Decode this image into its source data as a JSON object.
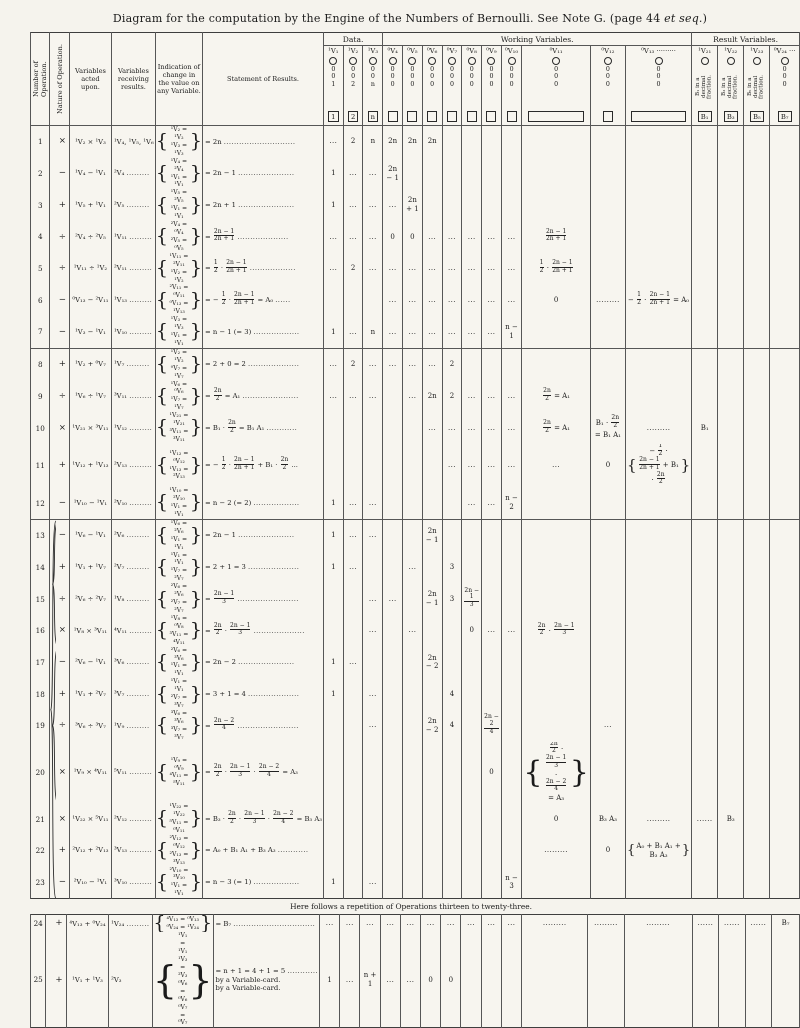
{
  "page": {
    "title_pre": "Diagram for the computation by the Engine of the Numbers of Bernoulli.  See Note G. (page 44 ",
    "title_em": "et seq.",
    "title_post": ")"
  },
  "table": {
    "left_headers": [
      "Number of Operation.",
      "Nature of Operation.",
      "Variables acted upon.",
      "Variables receiving results.",
      "Indication of change in the value on any Variable.",
      "Statement of Results."
    ],
    "groups": {
      "data": "Data.",
      "working": "Working Variables.",
      "result": "Result Variables."
    },
    "banner": "Here follows a repetition of Operations thirteen to twenty-three.",
    "columns": [
      {
        "id": "v1",
        "label": "¹V₁",
        "zeros": [
          "0",
          "0",
          "1"
        ],
        "box": "1"
      },
      {
        "id": "v2",
        "label": "¹V₂",
        "zeros": [
          "0",
          "0",
          "2"
        ],
        "box": "2"
      },
      {
        "id": "v3",
        "label": "¹V₃",
        "zeros": [
          "0",
          "0",
          "n"
        ],
        "box": "n"
      },
      {
        "id": "v4",
        "label": "⁰V₄",
        "zeros": [
          "0",
          "0",
          "0"
        ],
        "box": ""
      },
      {
        "id": "v5",
        "label": "⁰V₅",
        "zeros": [
          "0",
          "0",
          "0"
        ],
        "box": ""
      },
      {
        "id": "v6",
        "label": "⁰V₆",
        "zeros": [
          "0",
          "0",
          "0"
        ],
        "box": ""
      },
      {
        "id": "v7",
        "label": "⁰V₇",
        "zeros": [
          "0",
          "0",
          "0"
        ],
        "box": ""
      },
      {
        "id": "v8",
        "label": "⁰V₈",
        "zeros": [
          "0",
          "0",
          "0"
        ],
        "box": ""
      },
      {
        "id": "v9",
        "label": "⁰V₉",
        "zeros": [
          "0",
          "0",
          "0"
        ],
        "box": ""
      },
      {
        "id": "v10",
        "label": "⁰V₁₀",
        "zeros": [
          "0",
          "0",
          "0"
        ],
        "box": ""
      },
      {
        "id": "v11",
        "label": "⁰V₁₁",
        "zeros": [
          "0",
          "0",
          "0"
        ],
        "box": "",
        "wide": true
      },
      {
        "id": "v12",
        "label": "⁰V₁₂",
        "zeros": [
          "0",
          "0",
          "0"
        ],
        "box": ""
      },
      {
        "id": "v13",
        "label": "⁰V₁₃ ·········",
        "zeros": [
          "0",
          "0",
          "0"
        ],
        "box": "",
        "wide": true
      },
      {
        "id": "v21",
        "label": "¹V₂₁",
        "rot": "B₁ in a decimal fraction.",
        "box": "B₁"
      },
      {
        "id": "v22",
        "label": "¹V₂₂",
        "rot": "B₃ in a decimal fraction.",
        "box": "B₃"
      },
      {
        "id": "v23",
        "label": "¹V₂₃",
        "rot": "B₅ in a decimal fraction.",
        "box": "B₅"
      },
      {
        "id": "v24",
        "label": "⁰V₂₄ ···",
        "zeros": [
          "0",
          "0",
          "0"
        ],
        "box": "B₇"
      }
    ],
    "rows": [
      {
        "block": 1,
        "n": "1",
        "op": "×",
        "a": "¹V₂ × ¹V₃",
        "r": "¹V₄, ¹V₅, ¹V₆",
        "i": [
          "¹V₂ = ¹V₂",
          "¹V₃ = ¹V₃"
        ],
        "s": "= 2n ............................",
        "c": {
          "v1": "...",
          "v2": "2",
          "v3": "n",
          "v4": "2n",
          "v5": "2n",
          "v6": "2n"
        }
      },
      {
        "block": 1,
        "n": "2",
        "op": "−",
        "a": "¹V₄ − ¹V₁",
        "r": "²V₄ .........",
        "i": [
          "¹V₄ = ²V₄",
          "¹V₁ = ¹V₁"
        ],
        "s": "= 2n − 1 ......................",
        "c": {
          "v1": "1",
          "v2": "...",
          "v3": "...",
          "v4": "2n − 1"
        }
      },
      {
        "block": 1,
        "n": "3",
        "op": "+",
        "a": "¹V₅ + ¹V₁",
        "r": "²V₅ .........",
        "i": [
          "¹V₅ = ²V₅",
          "¹V₁ = ¹V₁"
        ],
        "s": "= 2n + 1 ......................",
        "c": {
          "v1": "1",
          "v2": "...",
          "v3": "...",
          "v4": "...",
          "v5": "2n + 1"
        }
      },
      {
        "block": 1,
        "n": "4",
        "op": "÷",
        "a": "²V₄ ÷ ²V₅",
        "r": "¹V₁₁ .........",
        "i": [
          "²V₄ = ⁰V₄",
          "²V₅ = ⁰V₅"
        ],
        "s": "= [[2n − 1|2n + 1]] ....................",
        "c": {
          "v1": "...",
          "v2": "...",
          "v3": "...",
          "v4": "0",
          "v5": "0",
          "v6": "...",
          "v7": "...",
          "v8": "...",
          "v9": "...",
          "v10": "...",
          "v11": "[[2n − 1|2n + 1]]"
        }
      },
      {
        "block": 1,
        "n": "5",
        "op": "÷",
        "a": "¹V₁₁ ÷ ¹V₂",
        "r": "²V₁₁ .........",
        "i": [
          "¹V₁₁ = ²V₁₁",
          "¹V₂ = ¹V₂"
        ],
        "s": "= [[1|2]] · [[2n − 1|2n + 1]] ..................",
        "c": {
          "v1": "...",
          "v2": "2",
          "v3": "...",
          "v4": "...",
          "v5": "...",
          "v6": "...",
          "v7": "...",
          "v8": "...",
          "v9": "...",
          "v10": "...",
          "v11": "[[1|2]] · [[2n − 1|2n + 1]]"
        }
      },
      {
        "block": 1,
        "n": "6",
        "op": "−",
        "a": "⁰V₁₃ − ²V₁₁",
        "r": "¹V₁₃ .........",
        "i": [
          "²V₁₁ = ⁰V₁₁",
          "⁰V₁₃ = ¹V₁₃"
        ],
        "s": "= − [[1|2]] · [[2n − 1|2n + 1]] = A₀ ......",
        "c": {
          "v4": "...",
          "v5": "...",
          "v6": "...",
          "v7": "...",
          "v8": "...",
          "v9": "...",
          "v10": "...",
          "v11": "0",
          "v12": ".........",
          "v13": "− [[1|2]] · [[2n − 1|2n + 1]] = A₀"
        }
      },
      {
        "block": 1,
        "n": "7",
        "op": "−",
        "a": "¹V₃ − ¹V₁",
        "r": "¹V₁₀ .........",
        "i": [
          "¹V₃ = ¹V₃",
          "¹V₁ = ¹V₁"
        ],
        "s": "= n − 1 (= 3) ..................",
        "c": {
          "v1": "1",
          "v2": "...",
          "v3": "n",
          "v4": "...",
          "v5": "...",
          "v6": "...",
          "v7": "...",
          "v8": "...",
          "v9": "...",
          "v10": "n − 1"
        }
      },
      {
        "block": 2,
        "n": "8",
        "op": "+",
        "a": "¹V₂ + ⁰V₇",
        "r": "¹V₇ .........",
        "i": [
          "¹V₂ = ¹V₂",
          "⁰V₇ = ¹V₇"
        ],
        "s": "= 2 + 0 = 2 ....................",
        "c": {
          "v1": "...",
          "v2": "2",
          "v3": "...",
          "v4": "...",
          "v5": "...",
          "v6": "...",
          "v7": "2"
        }
      },
      {
        "block": 2,
        "n": "9",
        "op": "÷",
        "a": "¹V₆ ÷ ¹V₇",
        "r": "³V₁₁ .........",
        "i": [
          "¹V₆ = ⁰V₆",
          "¹V₇ = ¹V₇"
        ],
        "s": "= [[2n|2]] = A₁ ......................",
        "c": {
          "v1": "...",
          "v2": "...",
          "v3": "...",
          "v5": "...",
          "v6": "2n",
          "v7": "2",
          "v8": "...",
          "v9": "...",
          "v10": "...",
          "v11": "[[2n|2]] = A₁"
        }
      },
      {
        "block": 2,
        "n": "10",
        "op": "×",
        "a": "¹V₂₁ × ³V₁₁",
        "r": "¹V₁₂ .........",
        "i": [
          "¹V₂₁ = ¹V₂₁",
          "³V₁₁ = ³V₁₁"
        ],
        "s": "= B₁ · [[2n|2]] = B₁ A₁ ............",
        "c": {
          "v6": "...",
          "v7": "...",
          "v8": "...",
          "v9": "...",
          "v10": "...",
          "v11": "[[2n|2]] = A₁",
          "v12": "B₁ · [[2n|2]] = B₁ A₁",
          "v13": ".........",
          "v21": "B₁"
        }
      },
      {
        "block": 2,
        "n": "11",
        "op": "+",
        "a": "¹V₁₂ + ¹V₁₃",
        "r": "²V₁₃ .........",
        "i": [
          "¹V₁₂ = ⁰V₁₂",
          "¹V₁₃ = ²V₁₃"
        ],
        "s": "= − [[1|2]] · [[2n − 1|2n + 1]] + B₁ · [[2n|2]] ...",
        "c": {
          "v7": "...",
          "v8": "...",
          "v9": "...",
          "v10": "...",
          "v11": "...",
          "v12": "0",
          "v13": {
            "brace": true,
            "lines": [
              "− [[1|2]] · [[2n − 1|2n + 1]] + B₁ · [[2n|2]]"
            ]
          }
        }
      },
      {
        "block": 2,
        "n": "12",
        "op": "−",
        "a": "¹V₁₀ − ¹V₁",
        "r": "²V₁₀ .........",
        "i": [
          "¹V₁₀ = ²V₁₀",
          "¹V₁ = ¹V₁"
        ],
        "s": "= n − 2 (= 2) ..................",
        "c": {
          "v1": "1",
          "v2": "...",
          "v3": "...",
          "v8": "...",
          "v9": "...",
          "v10": "n − 2"
        }
      },
      {
        "block": 3,
        "n": "13",
        "op": "−",
        "a": "¹V₆ − ¹V₁",
        "r": "²V₆ .........",
        "i": [
          "¹V₆ = ²V₆",
          "¹V₁ = ¹V₁"
        ],
        "s": "= 2n − 1 ......................",
        "c": {
          "v1": "1",
          "v2": "...",
          "v3": "...",
          "v6": "2n − 1"
        }
      },
      {
        "block": 3,
        "n": "14",
        "op": "+",
        "a": "¹V₁ + ¹V₇",
        "r": "²V₇ .........",
        "i": [
          "¹V₁ = ¹V₁",
          "¹V₇ = ²V₇"
        ],
        "s": "= 2 + 1 = 3 ....................",
        "c": {
          "v1": "1",
          "v2": "...",
          "v5": "...",
          "v7": "3"
        }
      },
      {
        "block": 3,
        "n": "15",
        "op": "÷",
        "a": "²V₆ ÷ ²V₇",
        "r": "¹V₈ .........",
        "i": [
          "²V₆ = ²V₆",
          "²V₇ = ²V₇"
        ],
        "s": "= [[2n − 1|3]] ........................",
        "c": {
          "v3": "...",
          "v4": "...",
          "v6": "2n − 1",
          "v7": "3",
          "v8": "[[2n − 1|3]]"
        }
      },
      {
        "block": 3,
        "n": "16",
        "op": "×",
        "a": "¹V₈ × ³V₁₁",
        "r": "⁴V₁₁ .........",
        "i": [
          "¹V₈ = ⁰V₈",
          "³V₁₁ = ⁴V₁₁"
        ],
        "s": "= [[2n|2]] · [[2n − 1|3]] ....................",
        "c": {
          "v3": "...",
          "v5": "...",
          "v8": "0",
          "v9": "...",
          "v10": "...",
          "v11": "[[2n|2]] · [[2n − 1|3]]"
        }
      },
      {
        "block": 3,
        "n": "17",
        "op": "−",
        "a": "²V₆ − ¹V₁",
        "r": "³V₆ .........",
        "i": [
          "²V₆ = ³V₆",
          "¹V₁ = ¹V₁"
        ],
        "s": "= 2n − 2 ......................",
        "c": {
          "v1": "1",
          "v2": "...",
          "v6": "2n − 2"
        }
      },
      {
        "block": 3,
        "n": "18",
        "op": "+",
        "a": "¹V₁ + ²V₇",
        "r": "³V₇ .........",
        "i": [
          "¹V₁ = ¹V₁",
          "²V₇ = ³V₇"
        ],
        "s": "= 3 + 1 = 4 ....................",
        "c": {
          "v1": "1",
          "v3": "...",
          "v7": "4"
        }
      },
      {
        "block": 3,
        "n": "19",
        "op": "÷",
        "a": "³V₆ ÷ ³V₇",
        "r": "¹V₉ .........",
        "i": [
          "³V₆ = ³V₆",
          "³V₇ = ³V₇"
        ],
        "s": "= [[2n − 2|4]] ........................",
        "c": {
          "v3": "...",
          "v6": "2n − 2",
          "v7": "4",
          "v9": "[[2n − 2|4]]",
          "v12": "..."
        }
      },
      {
        "block": 3,
        "n": "20",
        "op": "×",
        "a": "¹V₉ × ⁴V₁₁",
        "r": "⁵V₁₁ .........",
        "i": [
          "¹V₉ = ⁰V₉",
          "⁴V₁₁ = ⁵V₁₁"
        ],
        "s": "= [[2n|2]] · [[2n − 1|3]] · [[2n − 2|4]] = A₃",
        "c": {
          "v9": "0",
          "v11": {
            "brace": true,
            "lines": [
              "[[2n|2]] · [[2n − 1|3]] · [[2n − 2|4]]",
              "= A₃"
            ]
          }
        }
      },
      {
        "block": 3,
        "n": "21",
        "op": "×",
        "a": "¹V₂₂ × ⁵V₁₁",
        "r": "²V₁₂ .........",
        "i": [
          "¹V₂₂ = ¹V₂₂",
          "⁵V₁₁ = ⁰V₁₁"
        ],
        "s": "= B₃ · [[2n|2]] · [[2n − 1|3]] · [[2n − 2|4]] = B₃ A₃",
        "c": {
          "v11": "0",
          "v12": "B₃ A₃",
          "v13": ".........",
          "v21": "......",
          "v22": "B₃"
        }
      },
      {
        "block": 3,
        "n": "22",
        "op": "+",
        "a": "²V₁₂ + ²V₁₃",
        "r": "³V₁₃ .........",
        "i": [
          "²V₁₂ = ⁰V₁₂",
          "²V₁₃ = ³V₁₃"
        ],
        "s": "= A₀ + B₁ A₁ + B₃ A₃ ............",
        "c": {
          "v11": ".........",
          "v12": "0",
          "v13": {
            "brace": true,
            "lines": [
              "A₀ + B₁ A₁ + B₃ A₃"
            ]
          }
        }
      },
      {
        "block": 3,
        "n": "23",
        "op": "−",
        "a": "²V₁₀ − ¹V₁",
        "r": "³V₁₀ .........",
        "i": [
          "²V₁₀ = ³V₁₀",
          "¹V₁ = ¹V₁"
        ],
        "s": "= n − 3 (= 1) ..................",
        "c": {
          "v1": "1",
          "v3": "...",
          "v10": "n − 3"
        }
      },
      {
        "block": 4,
        "n": "24",
        "op": "+",
        "a": "⁴V₁₃ + ⁰V₂₄",
        "r": "¹V₂₄ .........",
        "i": [
          "⁴V₁₃ = ⁰V₁₃",
          "⁰V₂₄ = ¹V₂₄"
        ],
        "s": "= B₇ ................................",
        "c": {
          "v1": "...",
          "v2": "...",
          "v3": "...",
          "v4": "...",
          "v5": "...",
          "v6": "...",
          "v7": "...",
          "v8": "...",
          "v9": "...",
          "v10": "...",
          "v11": ".........",
          "v12": ".........",
          "v13": ".........",
          "v21": "......",
          "v22": "......",
          "v23": "......",
          "v24": "B₇"
        }
      },
      {
        "block": 4,
        "n": "25",
        "op": "+",
        "a": "¹V₁ + ¹V₃",
        "r": "²V₃",
        "i": [
          "¹V₁ = ¹V₁",
          "¹V₃ = ²V₃",
          "⁰V₆ = ⁰V₆",
          "⁰V₇ = ⁰V₇"
        ],
        "s": [
          "= n + 1 = 4 + 1 = 5 ............",
          "by a Variable-card.",
          "by a Variable-card."
        ],
        "c": {
          "v1": "1",
          "v2": "...",
          "v3": "n + 1",
          "v4": "...",
          "v5": "...",
          "v6": "0",
          "v7": "0"
        }
      }
    ]
  }
}
